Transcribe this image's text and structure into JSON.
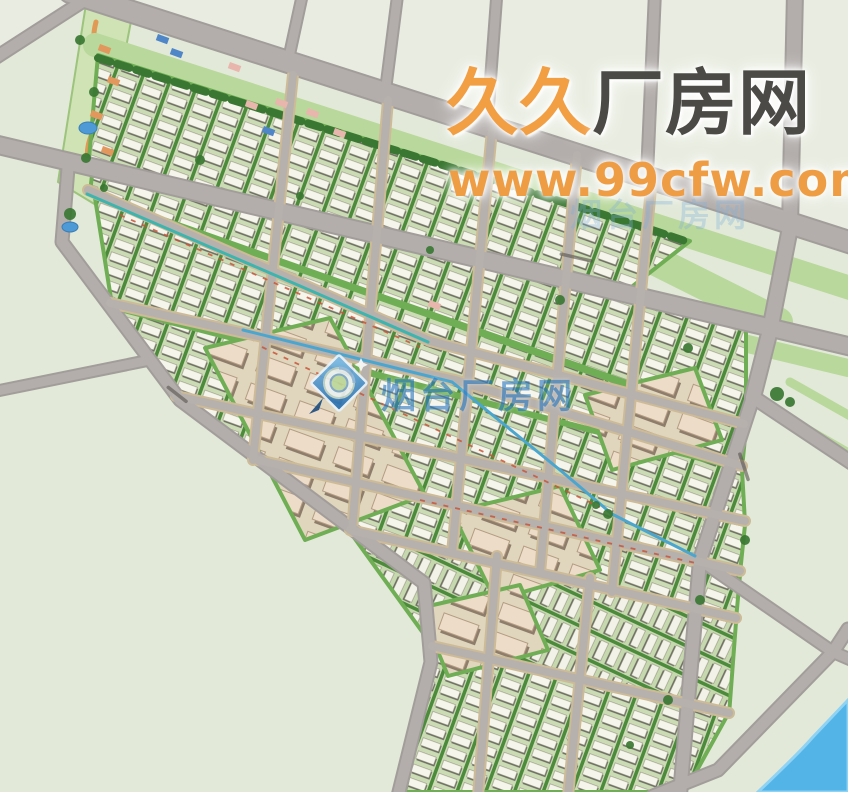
{
  "watermarks": {
    "main": {
      "part1": "久久",
      "part2": "厂房网",
      "color1": "#f29e43",
      "color2": "#4b4a47"
    },
    "url": {
      "text": "www.99cfw.com",
      "color": "#ef9d45"
    },
    "faint": {
      "text": "烟台厂房网",
      "color": "#7fb0dc"
    },
    "center": {
      "text": "烟台厂房网",
      "color": "#2e7cc4",
      "logo": "yantai-cfw-compass-logo"
    }
  },
  "map": {
    "width": 848,
    "height": 792,
    "colors": {
      "bg": "#e2e9d9",
      "field": "#e9ede1",
      "roadMajor": "#b3aeac",
      "roadMinor": "#b6b1ad",
      "casingMajor": "#a29d9a",
      "casingMinor": "#cdbb97",
      "belt": "#b9d89b",
      "blockStroke": "#6fae54",
      "tree": "#3a7732",
      "river": "#53b4e8",
      "riverEdge": "#8ed2f4",
      "pond": "#4e9ad6",
      "park": "#cfe3b4",
      "parkStroke": "#9cc47c",
      "parkPath": "#e09a55",
      "dash": "#c85538",
      "label": "#56514d"
    },
    "fields": [
      {
        "name": "north-open-land",
        "pts": [
          [
            70,
            0
          ],
          [
            848,
            0
          ],
          [
            848,
            244
          ]
        ]
      },
      {
        "name": "northwest-open-land",
        "pts": [
          [
            0,
            0
          ],
          [
            86,
            0
          ],
          [
            0,
            60
          ]
        ]
      }
    ],
    "belts": [
      {
        "name": "upper-arterial-greenbelt",
        "pts": [
          [
            95,
            45
          ],
          [
            850,
            288
          ]
        ],
        "w": 24
      },
      {
        "name": "mid-greenbelt",
        "pts": [
          [
            610,
            238
          ],
          [
            778,
            322
          ]
        ],
        "w": 30
      },
      {
        "name": "lower-arterial-greenbelt",
        "pts": [
          [
            565,
            300
          ],
          [
            848,
            368
          ]
        ],
        "w": 18
      },
      {
        "name": "east-spur-greenbelt-1",
        "pts": [
          [
            772,
            410
          ],
          [
            850,
            455
          ]
        ],
        "w": 11
      },
      {
        "name": "east-spur-greenbelt-2",
        "pts": [
          [
            790,
            382
          ],
          [
            852,
            417
          ]
        ],
        "w": 9
      }
    ],
    "blocks": [
      {
        "name": "industrial-strip-1",
        "pts": [
          [
            98,
            55
          ],
          [
            690,
            241
          ],
          [
            615,
            300
          ],
          [
            88,
            170
          ]
        ],
        "fill": "wh"
      },
      {
        "name": "industrial-strip-2",
        "pts": [
          [
            92,
            175
          ],
          [
            746,
            327
          ],
          [
            746,
            424
          ],
          [
            90,
            193
          ]
        ],
        "fill": "wh"
      },
      {
        "name": "industrial-strip-3",
        "pts": [
          [
            95,
            198
          ],
          [
            746,
            428
          ],
          [
            742,
            468
          ],
          [
            112,
            305
          ]
        ],
        "fill": "wh"
      },
      {
        "name": "industrial-strip-4",
        "pts": [
          [
            112,
            308
          ],
          [
            742,
            470
          ],
          [
            745,
            523
          ],
          [
            174,
            396
          ]
        ],
        "fill": "wh"
      },
      {
        "name": "industrial-strip-5",
        "pts": [
          [
            176,
            398
          ],
          [
            745,
            525
          ],
          [
            740,
            573
          ],
          [
            258,
            461
          ]
        ],
        "fill": "wh"
      },
      {
        "name": "industrial-strip-6",
        "pts": [
          [
            258,
            462
          ],
          [
            740,
            575
          ],
          [
            736,
            620
          ],
          [
            348,
            530
          ]
        ],
        "fill": "wh"
      },
      {
        "name": "industrial-strip-7",
        "pts": [
          [
            350,
            532
          ],
          [
            736,
            622
          ],
          [
            729,
            715
          ],
          [
            434,
            648
          ]
        ],
        "fill": "wh2"
      },
      {
        "name": "industrial-strip-8",
        "pts": [
          [
            436,
            650
          ],
          [
            727,
            716
          ],
          [
            685,
            792
          ],
          [
            405,
            792
          ]
        ],
        "fill": "wh"
      },
      {
        "name": "big-factory-block-1",
        "pts": [
          [
            205,
            348
          ],
          [
            330,
            318
          ],
          [
            425,
            495
          ],
          [
            305,
            540
          ]
        ],
        "fill": "big"
      },
      {
        "name": "big-factory-block-2",
        "pts": [
          [
            452,
            512
          ],
          [
            560,
            486
          ],
          [
            600,
            570
          ],
          [
            495,
            600
          ]
        ],
        "fill": "big"
      },
      {
        "name": "big-factory-block-3",
        "pts": [
          [
            585,
            395
          ],
          [
            695,
            368
          ],
          [
            722,
            440
          ],
          [
            612,
            470
          ]
        ],
        "fill": "big"
      },
      {
        "name": "big-factory-block-4",
        "pts": [
          [
            420,
            608
          ],
          [
            520,
            585
          ],
          [
            548,
            650
          ],
          [
            448,
            676
          ]
        ],
        "fill": "big"
      }
    ],
    "treeLines": [
      {
        "name": "arterial-tree-row",
        "pts": [
          [
            98,
            58
          ],
          [
            200,
            90
          ],
          [
            310,
            124
          ],
          [
            420,
            158
          ],
          [
            530,
            192
          ],
          [
            640,
            226
          ],
          [
            688,
            242
          ]
        ],
        "w": 8
      },
      {
        "name": "boundary-tree-row",
        "pts": [
          [
            72,
            252
          ],
          [
            180,
            402
          ],
          [
            300,
            492
          ],
          [
            420,
            582
          ]
        ],
        "w": 6
      }
    ],
    "roads": [
      {
        "name": "upper-arterial-road",
        "pts": [
          [
            70,
            -8
          ],
          [
            852,
            243
          ]
        ],
        "w": 20,
        "c": "major"
      },
      {
        "name": "lower-arterial-road",
        "pts": [
          [
            -6,
            144
          ],
          [
            852,
            347
          ]
        ],
        "w": 16,
        "c": "major"
      },
      {
        "name": "northwest-branch-road",
        "pts": [
          [
            85,
            0
          ],
          [
            -8,
            60
          ]
        ],
        "w": 11,
        "c": "major"
      },
      {
        "name": "north-road-1",
        "pts": [
          [
            303,
            -8
          ],
          [
            287,
            66
          ]
        ],
        "w": 9,
        "c": "major"
      },
      {
        "name": "north-road-2",
        "pts": [
          [
            398,
            -8
          ],
          [
            385,
            94
          ]
        ],
        "w": 9,
        "c": "major"
      },
      {
        "name": "north-road-3",
        "pts": [
          [
            497,
            -8
          ],
          [
            487,
            127
          ]
        ],
        "w": 9,
        "c": "major"
      },
      {
        "name": "north-road-4",
        "pts": [
          [
            655,
            -8
          ],
          [
            647,
            175
          ]
        ],
        "w": 10,
        "c": "major"
      },
      {
        "name": "east-arterial-road",
        "pts": [
          [
            795,
            -8
          ],
          [
            790,
            228
          ],
          [
            770,
            330
          ],
          [
            753,
            397
          ]
        ],
        "w": 14,
        "c": "major"
      },
      {
        "name": "east-boundary-road",
        "pts": [
          [
            753,
            397
          ],
          [
            700,
            560
          ],
          [
            680,
            795
          ]
        ],
        "w": 12,
        "c": "major"
      },
      {
        "name": "east-spur-road",
        "pts": [
          [
            753,
            397
          ],
          [
            852,
            463
          ]
        ],
        "w": 12,
        "c": "major"
      },
      {
        "name": "riverside-road",
        "pts": [
          [
            848,
            629
          ],
          [
            833,
            652
          ],
          [
            718,
            770
          ],
          [
            653,
            796
          ]
        ],
        "w": 11,
        "c": "major"
      },
      {
        "name": "river-crossing-road",
        "pts": [
          [
            700,
            560
          ],
          [
            833,
            652
          ],
          [
            854,
            661
          ]
        ],
        "w": 10,
        "c": "major"
      },
      {
        "name": "southwest-boundary-road",
        "pts": [
          [
            68,
            168
          ],
          [
            62,
            242
          ],
          [
            180,
            400
          ],
          [
            300,
            490
          ],
          [
            424,
            583
          ],
          [
            431,
            662
          ],
          [
            398,
            796
          ]
        ],
        "w": 11,
        "c": "major"
      },
      {
        "name": "west-stub-road",
        "pts": [
          [
            -8,
            392
          ],
          [
            150,
            360
          ]
        ],
        "w": 9,
        "c": "major"
      },
      {
        "name": "canal-road-1",
        "pts": [
          [
            88,
            190
          ],
          [
            300,
            283
          ],
          [
            430,
            341
          ],
          [
            744,
            424
          ]
        ],
        "w": 8,
        "c": "minor",
        "cas": true
      },
      {
        "name": "canal-road-2",
        "pts": [
          [
            110,
            303
          ],
          [
            455,
            380
          ],
          [
            742,
            466
          ]
        ],
        "w": 8,
        "c": "minor",
        "cas": true
      },
      {
        "name": "internal-road-3",
        "pts": [
          [
            176,
            396
          ],
          [
            745,
            521
          ]
        ],
        "w": 8,
        "c": "minor",
        "cas": true
      },
      {
        "name": "internal-road-4",
        "pts": [
          [
            258,
            460
          ],
          [
            740,
            571
          ]
        ],
        "w": 8,
        "c": "minor",
        "cas": true
      },
      {
        "name": "internal-road-5",
        "pts": [
          [
            350,
            530
          ],
          [
            736,
            618
          ]
        ],
        "w": 8,
        "c": "minor",
        "cas": true
      },
      {
        "name": "internal-road-6",
        "pts": [
          [
            432,
            646
          ],
          [
            729,
            713
          ]
        ],
        "w": 8,
        "c": "minor",
        "cas": true
      },
      {
        "name": "cross-road-1",
        "pts": [
          [
            293,
            75
          ],
          [
            253,
            460
          ]
        ],
        "w": 8,
        "c": "minor",
        "cas": true
      },
      {
        "name": "cross-road-2",
        "pts": [
          [
            388,
            100
          ],
          [
            352,
            531
          ]
        ],
        "w": 8,
        "c": "minor",
        "cas": true
      },
      {
        "name": "cross-road-3",
        "pts": [
          [
            492,
            130
          ],
          [
            452,
            553
          ]
        ],
        "w": 8,
        "c": "minor",
        "cas": true
      },
      {
        "name": "cross-road-4",
        "pts": [
          [
            577,
            155
          ],
          [
            540,
            573
          ]
        ],
        "w": 8,
        "c": "minor",
        "cas": true
      },
      {
        "name": "cross-road-5",
        "pts": [
          [
            652,
            178
          ],
          [
            612,
            592
          ]
        ],
        "w": 8,
        "c": "minor",
        "cas": true
      },
      {
        "name": "cross-road-6",
        "pts": [
          [
            497,
            556
          ],
          [
            478,
            796
          ]
        ],
        "w": 8,
        "c": "minor",
        "cas": true
      },
      {
        "name": "cross-road-7",
        "pts": [
          [
            590,
            578
          ],
          [
            568,
            796
          ]
        ],
        "w": 8,
        "c": "minor",
        "cas": true
      }
    ],
    "canals": [
      {
        "name": "canal-1",
        "pts": [
          [
            87,
            194
          ],
          [
            300,
            286
          ],
          [
            428,
            342
          ]
        ],
        "color": "#3db4ae"
      },
      {
        "name": "canal-2",
        "pts": [
          [
            243,
            330
          ],
          [
            452,
            382
          ],
          [
            560,
            470
          ],
          [
            612,
            514
          ],
          [
            695,
            556
          ]
        ],
        "color": "#4aa6cf"
      }
    ],
    "dashLines": [
      {
        "pts": [
          [
            120,
            215
          ],
          [
            420,
            347
          ]
        ]
      },
      {
        "pts": [
          [
            262,
            347
          ],
          [
            600,
            507
          ]
        ]
      },
      {
        "pts": [
          [
            420,
            500
          ],
          [
            700,
            564
          ]
        ]
      }
    ],
    "park": {
      "name": "northwest-park-strip",
      "poly": [
        [
          86,
          4
        ],
        [
          132,
          16
        ],
        [
          96,
          205
        ],
        [
          58,
          182
        ]
      ],
      "path": "M96,22 C86,60 112,70 104,100 C96,130 84,140 88,165"
    },
    "ponds": [
      {
        "cx": 88,
        "cy": 128,
        "rx": 9,
        "ry": 6
      },
      {
        "cx": 70,
        "cy": 227,
        "rx": 8,
        "ry": 5
      }
    ],
    "accents": {
      "orange": {
        "color": "#e2975c",
        "rects": [
          [
            100,
            44
          ],
          [
            109,
            76
          ],
          [
            92,
            110
          ],
          [
            103,
            146
          ]
        ]
      },
      "blue": {
        "color": "#4f86c8",
        "rects": [
          [
            158,
            34
          ],
          [
            172,
            48
          ],
          [
            264,
            126
          ]
        ]
      },
      "pink": {
        "color": "#e8b6ac",
        "rects": [
          [
            230,
            62
          ],
          [
            247,
            100
          ],
          [
            277,
            98
          ],
          [
            308,
            108
          ],
          [
            335,
            128
          ],
          [
            430,
            300
          ]
        ]
      }
    },
    "trees": [
      [
        80,
        40,
        5
      ],
      [
        94,
        92,
        5
      ],
      [
        86,
        158,
        5
      ],
      [
        70,
        214,
        6
      ],
      [
        104,
        188,
        4
      ],
      [
        200,
        160,
        5
      ],
      [
        300,
        196,
        4
      ],
      [
        430,
        250,
        4
      ],
      [
        560,
        300,
        5
      ],
      [
        688,
        348,
        5
      ],
      [
        777,
        394,
        7
      ],
      [
        790,
        402,
        5
      ],
      [
        745,
        540,
        5
      ],
      [
        700,
        600,
        5
      ],
      [
        668,
        700,
        5
      ],
      [
        630,
        745,
        4
      ],
      [
        608,
        514,
        5
      ],
      [
        596,
        505,
        4
      ]
    ],
    "river": {
      "name": "river",
      "d": "M848,700 L848,792 L758,792 Q800,752 812,738 Z"
    },
    "roadLabels": [
      {
        "x": 560,
        "y": 252,
        "rot": 13,
        "len": 34
      },
      {
        "x": 168,
        "y": 385,
        "rot": 38,
        "len": 26
      },
      {
        "x": 741,
        "y": 452,
        "rot": 72,
        "len": 30
      }
    ]
  }
}
